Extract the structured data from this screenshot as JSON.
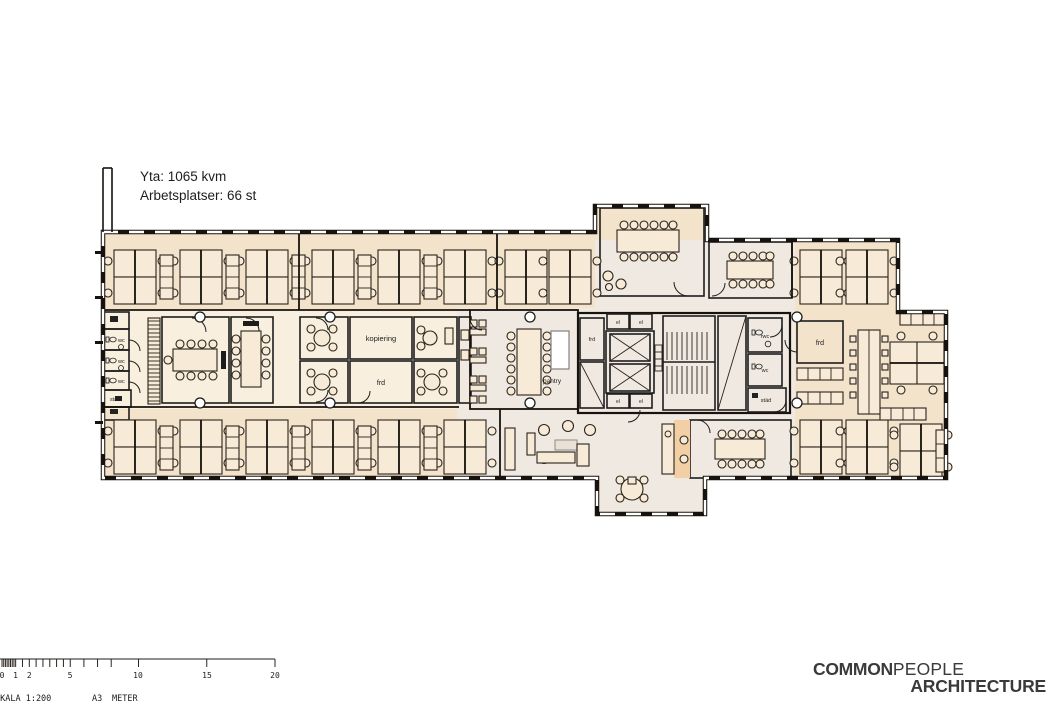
{
  "header": {
    "area": "Yta: 1065 kvm",
    "workplaces": "Arbetsplatser: 66 st"
  },
  "room_labels": {
    "wc": "wc",
    "stad": "städ",
    "el": "el",
    "kopiering": "kopiering",
    "frd": "frd",
    "pantry": "pantry",
    "rwc": "rwc"
  },
  "scalebar": {
    "labels": [
      "0",
      "1",
      "2",
      "5",
      "10",
      "15",
      "20"
    ],
    "scale": "SKALA 1:200",
    "paper": "A3",
    "unit": "METER"
  },
  "logo": {
    "word1": "COMMON",
    "word2": "PEOPLE",
    "word3": "ARCHITECTURE"
  },
  "colors": {
    "meeting_orange": "#ecaa6e",
    "small_room_orange": "#f1bd8c",
    "wet_room_tan": "#f3cfa6",
    "storage_brown": "#c2966b",
    "dark_brown": "#a37950",
    "service_brown": "#b18e68",
    "open_office": "#f4e3cb",
    "mid_zone": "#f8efde",
    "corridor": "#f0e9e1",
    "white_room": "#fbf7f1",
    "wall": "#17120d"
  }
}
